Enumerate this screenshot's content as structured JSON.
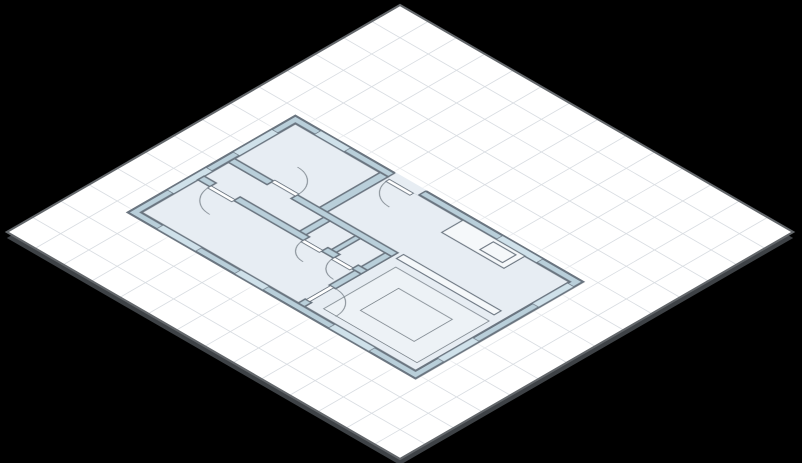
{
  "scene": {
    "background_color": "#000000",
    "plane": {
      "size": 556,
      "grid_size": 40,
      "fill": "#ffffff",
      "grid_line_color": "#d9dde2",
      "grid_line_width": 1.2,
      "border_color": "#63676b",
      "border_width": 3,
      "shadow_color": "#3e4246",
      "shadow_offset": 6,
      "center_x": 400,
      "center_y": 232,
      "iso_rotate_x_deg": 54.7356,
      "iso_rotate_z_deg": 45
    },
    "floorplan": {
      "x": 60,
      "y": 208,
      "width": 410,
      "height": 240,
      "wall_thickness": 11,
      "colors": {
        "wall_fill": "#b9cfda",
        "wall_stroke": "#6a7580",
        "floor": "#e7edf3",
        "window_fill": "#cfe1ea",
        "window_stroke": "#6a7580",
        "furniture_fill": "#f5f8fa",
        "rug_fill": "#edf2f6",
        "arc_stroke": "#7d868e",
        "door_fill": "#ffffff"
      },
      "outer_wall": {
        "x": 1.5,
        "y": 1.5,
        "w": 407,
        "h": 237,
        "stroke_width": 3
      },
      "floor_rect": {
        "x": 11,
        "y": 11,
        "w": 388,
        "h": 218,
        "stroke_width": 3
      },
      "entry_openings": [
        {
          "name": "entry-opening",
          "x": 142,
          "y": 0,
          "w": 44,
          "h": 12.5
        }
      ],
      "entry_jambs": "M142,1 L142,12 M186,1 L186,12",
      "interior_walls": [
        {
          "name": "bedroom-a-right-wall",
          "x": 131,
          "y": 11,
          "w": 11,
          "h": 86
        },
        {
          "name": "bedroom-a-bottom-wall-left",
          "x": 11,
          "y": 97,
          "w": 55,
          "h": 9
        },
        {
          "name": "hall-bottom-wall",
          "x": 100,
          "y": 97,
          "w": 142,
          "h": 9
        },
        {
          "name": "closet-left-wall",
          "x": 146,
          "y": 106,
          "w": 9,
          "h": 34
        },
        {
          "name": "closet-divider-wall",
          "x": 191,
          "y": 106,
          "w": 7,
          "h": 34
        },
        {
          "name": "closet-right-wall",
          "x": 233,
          "y": 106,
          "w": 9,
          "h": 34
        },
        {
          "name": "lower-room-top-wall-a",
          "x": 11,
          "y": 140,
          "w": 17,
          "h": 9
        },
        {
          "name": "lower-room-top-wall-b",
          "x": 62,
          "y": 140,
          "w": 98,
          "h": 9
        },
        {
          "name": "lower-room-top-wall-c",
          "x": 186,
          "y": 140,
          "w": 17,
          "h": 9
        },
        {
          "name": "lower-room-top-wall-d",
          "x": 229,
          "y": 140,
          "w": 13,
          "h": 9
        },
        {
          "name": "living-left-wall-upper",
          "x": 233,
          "y": 149,
          "w": 9,
          "h": 36
        },
        {
          "name": "living-left-wall-lower",
          "x": 233,
          "y": 219,
          "w": 9,
          "h": 10
        }
      ],
      "windows": [
        {
          "name": "window-top-left",
          "x": 38,
          "y": 2,
          "w": 42,
          "h": 9
        },
        {
          "name": "window-top-right",
          "x": 295,
          "y": 2,
          "w": 57,
          "h": 9
        },
        {
          "name": "window-left-upper",
          "x": 2,
          "y": 35,
          "w": 9,
          "h": 55
        },
        {
          "name": "window-left-lower",
          "x": 2,
          "y": 128,
          "w": 9,
          "h": 55
        },
        {
          "name": "window-right-upper",
          "x": 399,
          "y": 14,
          "w": 9,
          "h": 50
        },
        {
          "name": "window-right-lower",
          "x": 399,
          "y": 148,
          "w": 9,
          "h": 50
        },
        {
          "name": "window-bottom-left",
          "x": 42,
          "y": 229,
          "w": 55,
          "h": 9
        },
        {
          "name": "window-bottom-middle",
          "x": 152,
          "y": 229,
          "w": 40,
          "h": 9
        },
        {
          "name": "window-bottom-right",
          "x": 285,
          "y": 229,
          "w": 57,
          "h": 9
        }
      ],
      "doors": [
        {
          "name": "entry-door",
          "leaf": {
            "x": 146,
            "y": 13,
            "w": 34,
            "h": 5
          },
          "arc": "M146,13 A34,34 0 0 0 180,47"
        },
        {
          "name": "bedroom-a-door",
          "leaf": {
            "x": 66,
            "y": 95,
            "w": 34,
            "h": 5
          },
          "arc": "M66,63 A34,34 0 0 1 100,97"
        },
        {
          "name": "lower-room-door",
          "leaf": {
            "x": 28,
            "y": 147,
            "w": 34,
            "h": 5
          },
          "arc": "M28,149 A34,34 0 0 0 62,183"
        },
        {
          "name": "living-room-door",
          "leaf": {
            "x": 234.5,
            "y": 185,
            "w": 5,
            "h": 34
          },
          "arc": "M242,185 A34,34 0 0 1 276,219"
        },
        {
          "name": "closet-left-door",
          "leaf": {
            "x": 160,
            "y": 147,
            "w": 26,
            "h": 5
          },
          "arc": "M160,149 A26,26 0 0 0 186,175"
        },
        {
          "name": "closet-right-door",
          "leaf": {
            "x": 203,
            "y": 147,
            "w": 26,
            "h": 5
          },
          "arc": "M203,149 A26,26 0 0 0 229,175"
        }
      ],
      "furniture": [
        {
          "name": "kitchen-counter",
          "x": 248,
          "y": 11,
          "w": 88,
          "h": 30
        },
        {
          "name": "kitchen-sink",
          "x": 296,
          "y": 16,
          "w": 32,
          "h": 19
        },
        {
          "name": "kitchen-island",
          "x": 248,
          "y": 95,
          "w": 138,
          "h": 10
        }
      ],
      "rugs": [
        {
          "name": "living-rug-outer",
          "x": 258,
          "y": 116,
          "w": 132,
          "h": 102
        },
        {
          "name": "living-rug-inner",
          "x": 286,
          "y": 140,
          "w": 76,
          "h": 54
        }
      ]
    }
  }
}
